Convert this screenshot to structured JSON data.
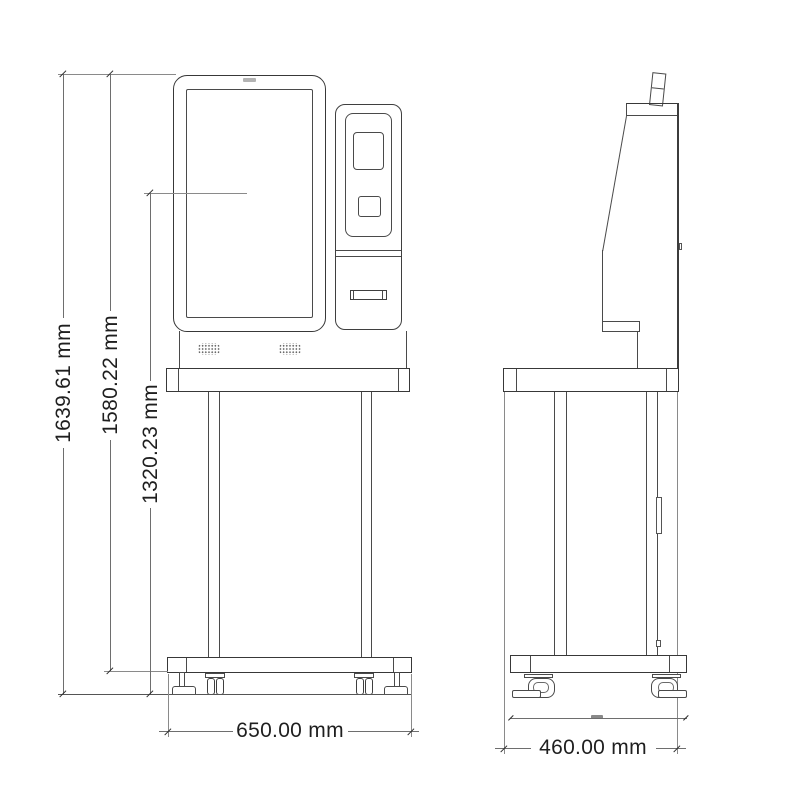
{
  "dimensions": {
    "overall_height": "1639.61 mm",
    "height_to_base_bottom": "1580.22 mm",
    "screen_center_height": "1320.23 mm",
    "width": "650.00 mm",
    "depth": "460.00 mm"
  },
  "colors": {
    "background": "#ffffff",
    "outline": "#3a3a3a",
    "thin_line": "#4a4a4a",
    "dimension_line": "#6e6e6e",
    "text": "#1f1f1f"
  }
}
